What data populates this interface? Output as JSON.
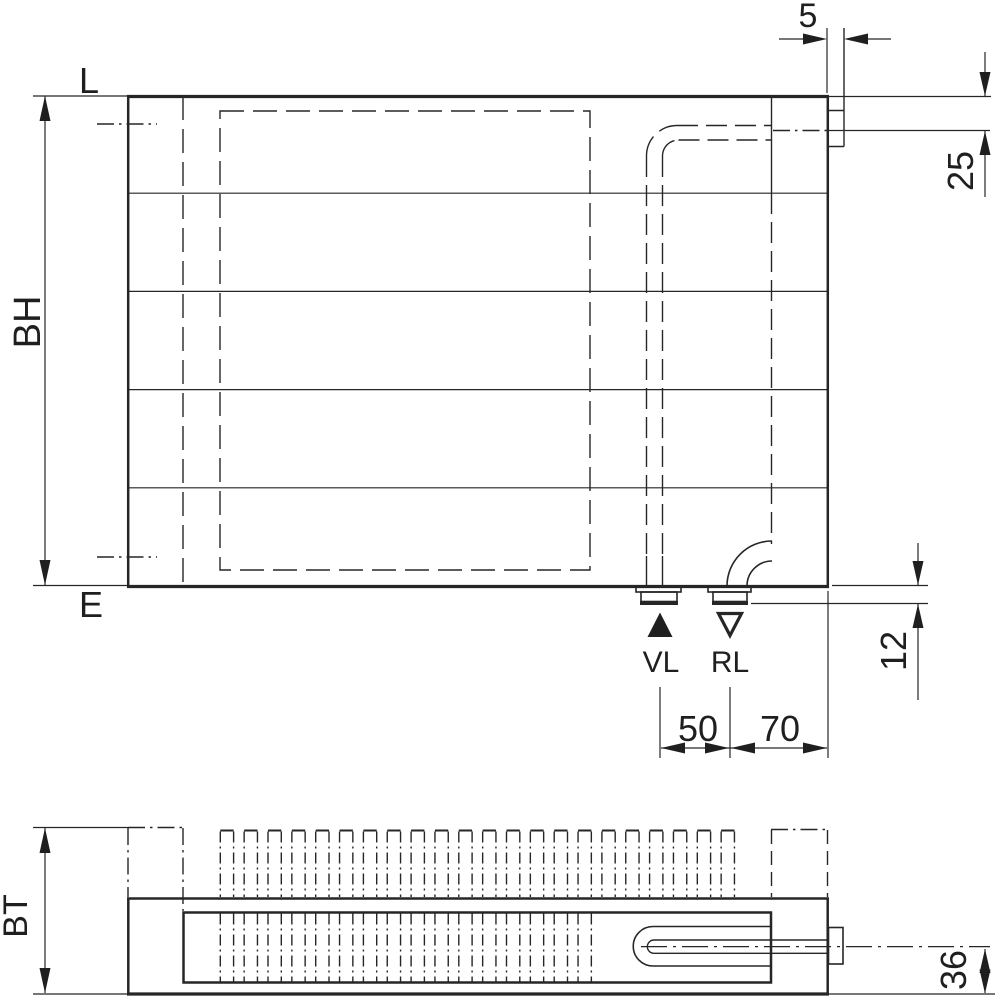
{
  "drawing": {
    "type": "radiator-dimension-drawing",
    "colors": {
      "line": "#262626",
      "text": "#1f1f1f",
      "background": "#ffffff"
    },
    "front_view": {
      "vent_label": "L",
      "drain_label": "E",
      "height_label": "BH",
      "valve_protrusion": "5",
      "valve_center_offset": "25",
      "connection_protrusion": "12",
      "supply_label": "VL",
      "return_label": "RL",
      "supply_marker": "filled-triangle-up",
      "return_marker": "open-triangle-down",
      "supply_return_spacing": "50",
      "return_to_edge_spacing": "70"
    },
    "plan_view": {
      "depth_label": "BT",
      "pipe_center_to_front": "36"
    }
  }
}
